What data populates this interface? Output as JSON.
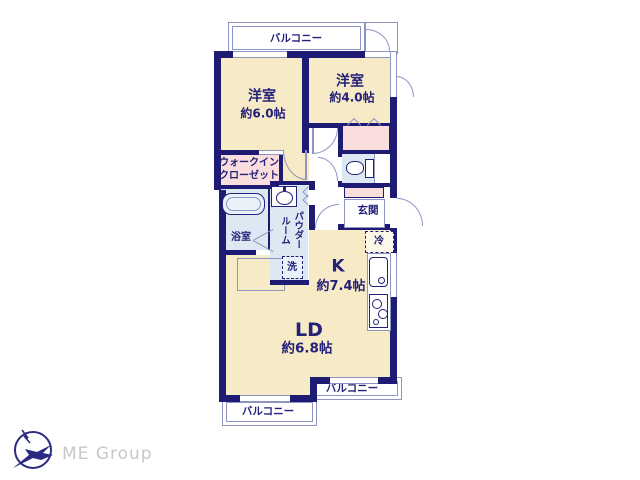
{
  "plan": {
    "type": "apartment-floor-plan",
    "rooms": {
      "bedroom1": {
        "name": "洋室",
        "size": "約6.0帖"
      },
      "bedroom2": {
        "name": "洋室",
        "size": "約4.0帖"
      },
      "walk_in_closet": {
        "name": "ウォークイン\nクローゼット"
      },
      "bathroom": {
        "name": "浴室"
      },
      "powder_room": {
        "name": "パウダー\nルーム"
      },
      "laundry": {
        "name": "洗"
      },
      "entrance": {
        "name": "玄関"
      },
      "refrigerator": {
        "name": "冷"
      },
      "kitchen": {
        "name": "K",
        "size": "約7.4帖"
      },
      "living_dining": {
        "name": "LD",
        "size": "約6.8帖"
      }
    },
    "balconies": {
      "top": {
        "name": "バルコニー"
      },
      "bottom_left": {
        "name": "バルコニー"
      },
      "bottom_right": {
        "name": "バルコニー"
      }
    },
    "colors": {
      "wall": "#1d1b73",
      "room_fill": "#f7eac6",
      "closet_fill": "#fadddd",
      "wet_area_fill": "#dce9f2",
      "line": "#8d95c0",
      "text": "#232178"
    }
  },
  "footer": {
    "brand": "ME Group",
    "brand_color": "#c8c8c8"
  }
}
